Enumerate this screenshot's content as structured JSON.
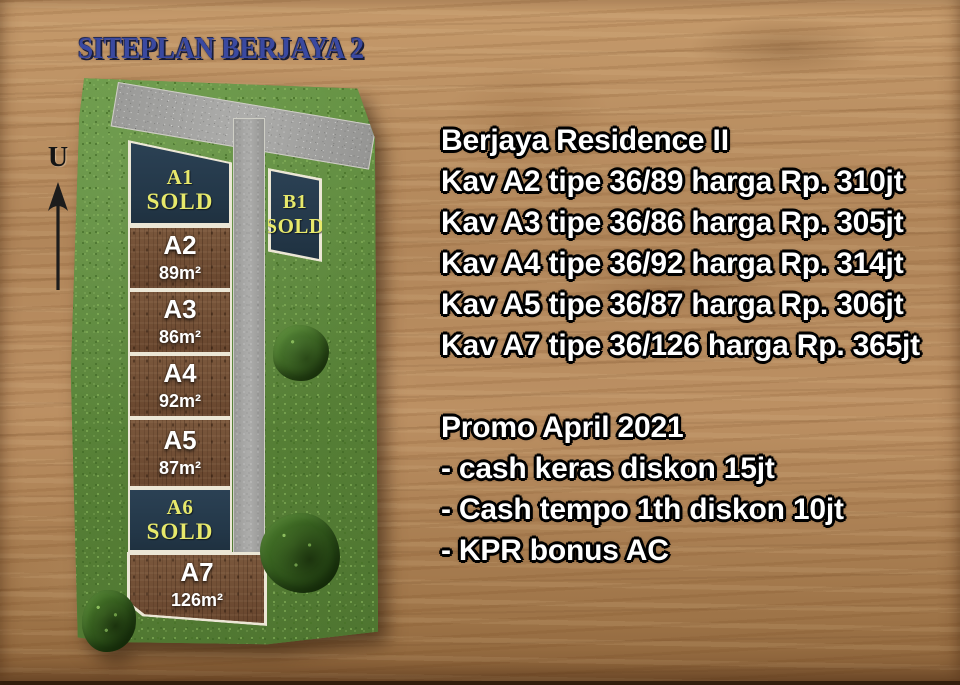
{
  "title": "SITEPLAN BERJAYA 2",
  "north_label": "U",
  "siteplan": {
    "plots": [
      {
        "id": "A1",
        "status": "SOLD"
      },
      {
        "id": "A2",
        "area": "89m²"
      },
      {
        "id": "A3",
        "area": "86m²"
      },
      {
        "id": "A4",
        "area": "92m²"
      },
      {
        "id": "A5",
        "area": "87m²"
      },
      {
        "id": "A6",
        "status": "SOLD"
      },
      {
        "id": "A7",
        "area": "126m²"
      },
      {
        "id": "B1",
        "status": "SOLD"
      }
    ]
  },
  "info": {
    "heading": "Berjaya Residence II",
    "listings": [
      "Kav A2 tipe 36/89 harga Rp. 310jt",
      "Kav A3 tipe 36/86 harga Rp. 305jt",
      "Kav A4 tipe 36/92 harga Rp. 314jt",
      "Kav A5 tipe 36/87 harga Rp. 306jt",
      "Kav A7 tipe 36/126 harga Rp. 365jt"
    ],
    "promo": {
      "heading": "Promo April 2021",
      "items": [
        "- cash keras diskon 15jt",
        "- Cash tempo 1th diskon 10jt",
        "- KPR bonus AC"
      ]
    }
  },
  "colors": {
    "title_blue": "#3a49a0",
    "sold_navy": "#253a4c",
    "sold_label_yellow": "#e7e96b",
    "grass_green": "#5f8f3f",
    "soil_brown": "#6f4e35",
    "road_gray": "#a6a6a4",
    "wood_tan": "#b1865a",
    "info_text": "#ffffff"
  }
}
